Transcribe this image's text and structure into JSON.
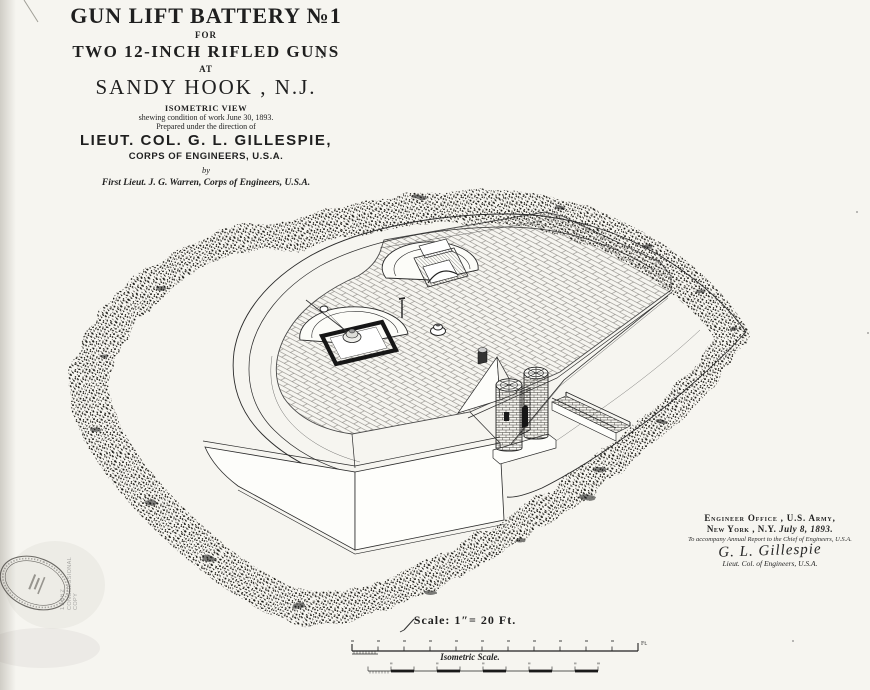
{
  "document": {
    "title_block": {
      "title": "GUN LIFT BATTERY №1",
      "for_label": "FOR",
      "subtitle": "TWO 12-INCH RIFLED GUNS",
      "at_label": "AT",
      "location": "SANDY HOOK , N.J.",
      "view_type": "ISOMETRIC VIEW",
      "condition_note": "shewing condition of work June 30, 1893.",
      "direction_note": "Prepared under the direction of",
      "director": "LIEUT. COL. G. L. GILLESPIE,",
      "director_org": "CORPS OF ENGINEERS, U.S.A.",
      "by_label": "by",
      "author": "First Lieut. J. G. Warren, Corps of Engineers, U.S.A."
    },
    "signature_block": {
      "office": "Engineer Office , U.S. Army,",
      "place": "New York , N.Y.",
      "date": "July 8, 1893.",
      "note": "To accompany Annual Report to the Chief of Engineers, U.S.A.",
      "signature": "G. L. Gillespie",
      "signer_title": "Lieut. Col. of Engineers, U.S.A."
    },
    "scale_block": {
      "scale_label": "Scale: 1″= 20 Ft.",
      "unit_label": "Ft.",
      "isometric_scale_label": "Isometric Scale."
    },
    "stamps": {
      "accession_number": "13862",
      "accession_note": "CONGRESSIONAL COPY"
    },
    "colors": {
      "ink": "#1f1f1f",
      "paper": "#f6f5f0"
    }
  }
}
